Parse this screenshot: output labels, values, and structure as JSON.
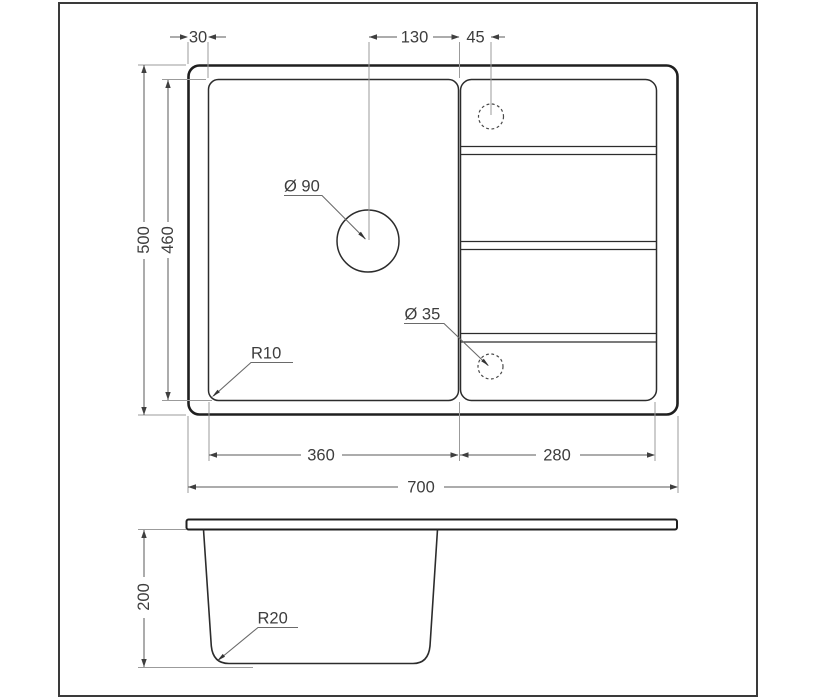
{
  "labels": {
    "rim_offset": "30",
    "drain_to_divider": "130",
    "divider_to_hole": "45",
    "outer_depth": "500",
    "bowl_depth": "460",
    "bowl_width": "360",
    "drainboard_width": "280",
    "overall_width": "700",
    "section_depth": "200",
    "drain_diameter": "Ø 90",
    "tap_hole_diameter": "Ø 35",
    "plan_corner_radius": "R10",
    "section_corner_radius": "R20"
  },
  "colors": {
    "background": "#ffffff",
    "frame": "#3a3a3a",
    "outline": "#1f1f1f",
    "thin_outline": "#2c2c2c",
    "dimension_line": "#5a5a5a",
    "extension_line": "#9b9b9b",
    "leader_line": "#6a6a6a",
    "arrowhead": "#3f3f3f",
    "text": "#3d3d3d"
  }
}
